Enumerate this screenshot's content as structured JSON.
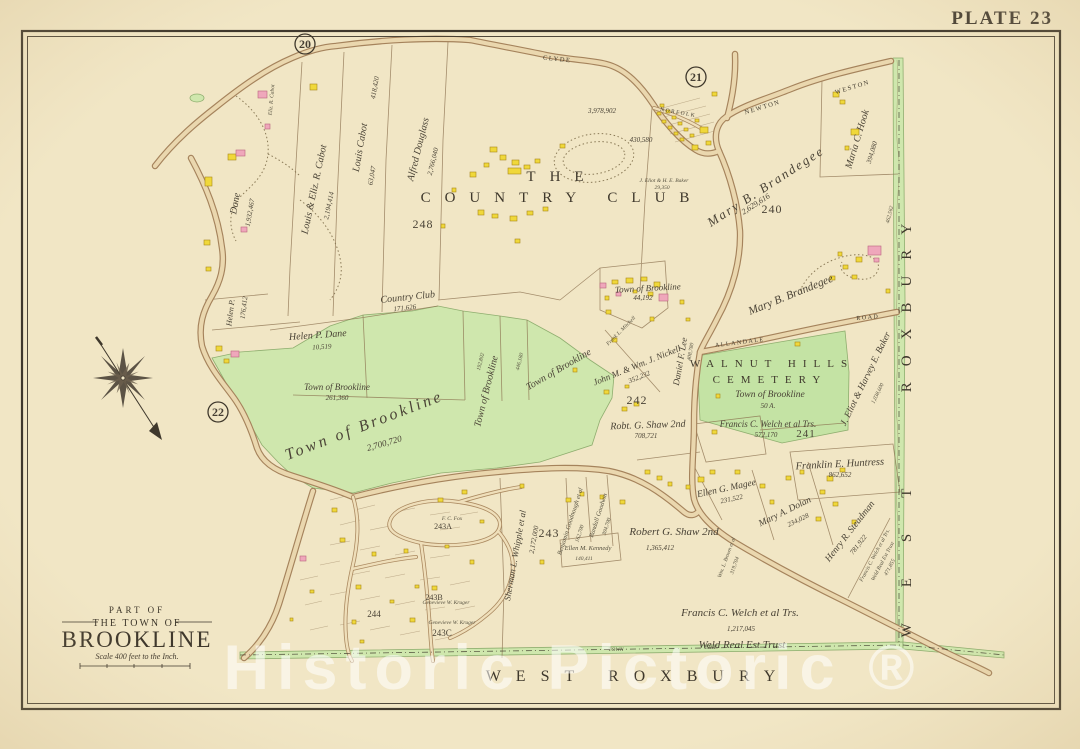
{
  "plate": {
    "title": "PLATE 23"
  },
  "adjacent_plates": {
    "p20": "20",
    "p21": "21",
    "p22": "22"
  },
  "watermark": {
    "text": "Historic Pictoric ®"
  },
  "title_block": {
    "part_of": "PART OF",
    "the_town_of": "THE TOWN OF",
    "town": "BROOKLINE",
    "scale": "Scale 400 feet to the Inch."
  },
  "boundaries": {
    "bottom_label": "WEST ROXBURY",
    "right_label_word1": "WEST",
    "right_label_word2": "ROXBURY",
    "town_word": "TOWN",
    "line_word": "LINE"
  },
  "streets": {
    "clyde": "CLYDE",
    "newton": "NEWTON",
    "weston": "WESTON",
    "norfolk": "NORFOLK",
    "allandale": "ALLANDALE",
    "allandale_road": "ROAD"
  },
  "landmarks": {
    "country_club": {
      "line1": "THE",
      "line2": "COUNTRY CLUB"
    },
    "cemetery": {
      "line1": "WALNUT HILLS",
      "line2": "CEMETERY",
      "owner": "Town of Brookline",
      "area": "50 A."
    }
  },
  "blocks": {
    "b248": "248",
    "b240": "240",
    "b241": "241",
    "b242": "242",
    "b243": "243",
    "b243a": "243A",
    "b243b": "243B",
    "b243c": "243C",
    "b244": "244"
  },
  "parcels": {
    "louis_eliz_cabot": {
      "name": "Louis & Eliz. R. Cabot",
      "area": "2,194,414"
    },
    "louis_cabot": {
      "name": "Louis Cabot",
      "area": "63,047",
      "area2": "418,420"
    },
    "alfred_douglass": {
      "name": "Alfred Douglass",
      "area": "2,766,040"
    },
    "eliz_cabot": {
      "name": "Eliz. R. Cabot"
    },
    "helen_dane": {
      "name": "Helen P. Dane",
      "area": "10,519"
    },
    "helen_dane_strip": {
      "name": "Dane",
      "area": "1,932,467"
    },
    "helen_dane_mid": {
      "name": "Helen P.",
      "area": "176,412"
    },
    "country_club_parcel": {
      "name": "Country Club",
      "area": "171,626"
    },
    "country_club_land": {
      "area": "3,978,902",
      "area2": "430,580"
    },
    "baker_small": {
      "name": "J. Eliot & H. E. Baker",
      "area": "29,350"
    },
    "baker_large": {
      "name": "J. Eliot & Harvey E. Baker",
      "area": "1,038,600"
    },
    "brandegee_north": {
      "name": "Mary B. Brandegee",
      "area": "2,629,616"
    },
    "brandegee_south": {
      "name": "Mary B. Brandegee"
    },
    "maria_hook": {
      "name": "Maria C. Hook",
      "area": "394,080"
    },
    "town_brookline_hospital": {
      "name": "Town of Brookline",
      "area": "44,192"
    },
    "nickell": {
      "name": "John M. & Wm. J. Nickell",
      "area": "352,232"
    },
    "lee": {
      "name": "Daniel F. Lee",
      "area": "408,780"
    },
    "mitchell": {
      "name": "Frank L. Mitchell"
    },
    "town_brookline_small": {
      "name": "Town of Brookline",
      "area": "261,360"
    },
    "town_brookline_large": {
      "name": "Town of Brookline",
      "area": "2,700,720"
    },
    "town_brookline_strip": {
      "name": "Town of Brookline",
      "area": "192,802",
      "area2": "446,180"
    },
    "town_brookline_ne": {
      "name": "Town of Brookline"
    },
    "shaw_north": {
      "name": "Robt. G. Shaw 2nd",
      "area": "708,721"
    },
    "shaw_south": {
      "name": "Robert G. Shaw 2nd",
      "area": "1,365,412"
    },
    "welch_mid": {
      "name": "Francis C. Welch et al Trs.",
      "area": "572,170"
    },
    "welch_south": {
      "name": "Francis C. Welch et al Trs.",
      "area": "1,217,045",
      "trust": "Weld Real Est Trust"
    },
    "welch_diag": {
      "name": "Francis C. Welch et al Trs.",
      "trust": "Weld Real Est Trust",
      "area": "471,855"
    },
    "huntress": {
      "name": "Franklin E. Huntress",
      "area": "862,652"
    },
    "magee": {
      "name": "Ellen G. Magee",
      "area": "231,522"
    },
    "dolan": {
      "name": "Mary A. Dolan",
      "area": "234,028"
    },
    "steadman": {
      "name": "Henry R. Steadman",
      "area": "781,922"
    },
    "brown": {
      "name": "Wm. L. Brown et al",
      "area": "319,704"
    },
    "kennedy": {
      "name": "Ellen M. Kennedy",
      "area": "140,411"
    },
    "goodnough": {
      "name": "Benjamin Goodnough et al",
      "area": "162,700"
    },
    "goodwin": {
      "name": "Randall Goodwin",
      "area": "304,700"
    },
    "whipple": {
      "name": "Sherman L. Whipple et al",
      "area": "2,172,000"
    },
    "boundary_area": {
      "area": "462,562"
    },
    "fox": {
      "name": "F. C. Fox"
    },
    "kruger": {
      "name": "Genevieve W. Kruger"
    }
  },
  "colors": {
    "paper": "#f1e6c5",
    "green": "#cfe7ad",
    "road_fill": "#ead7ae",
    "road_edge": "#a5835c",
    "building_yellow": "#f0d83a",
    "building_pink": "#efa7bb",
    "ink": "#453e33"
  }
}
